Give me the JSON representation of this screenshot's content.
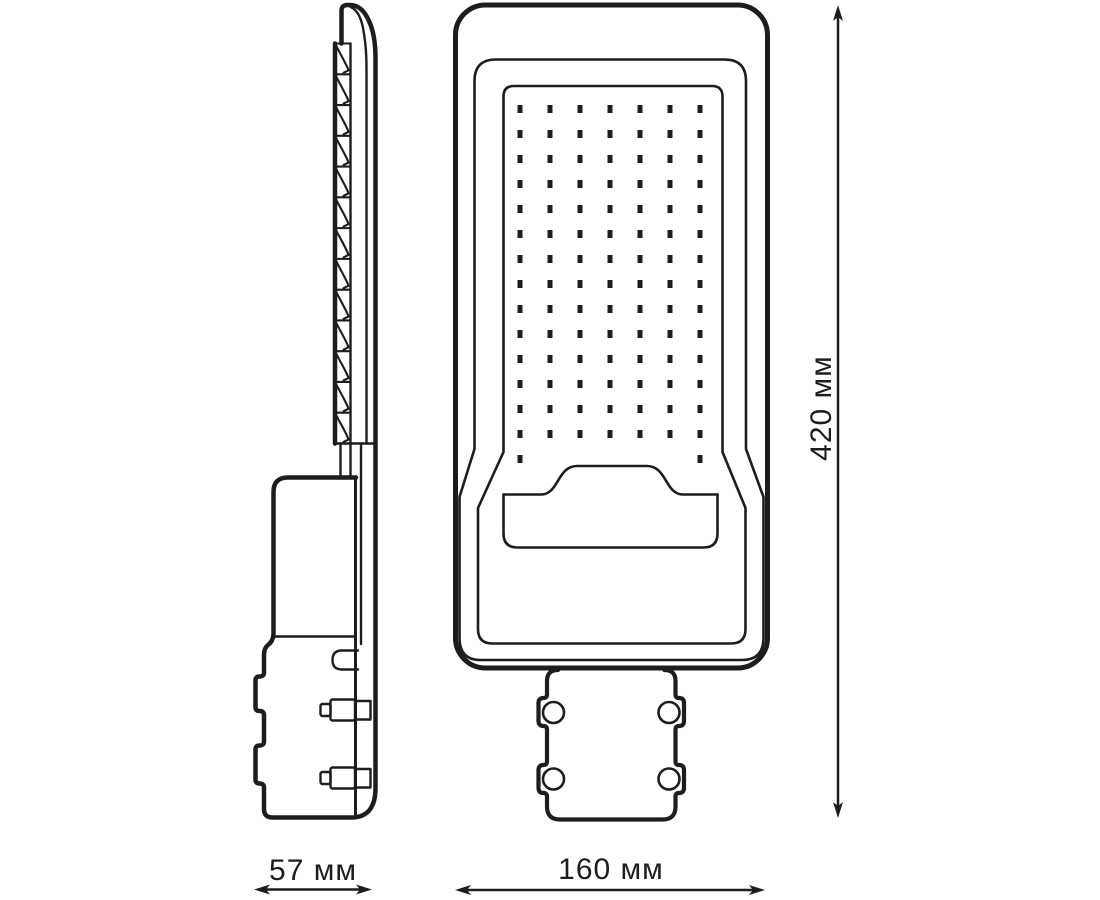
{
  "title": "LED street light dimensional drawing",
  "colors": {
    "line": "#1d1d1b",
    "background": "#ffffff"
  },
  "views": {
    "side": {
      "fins_count": 13
    },
    "front": {
      "led_count": 100
    }
  },
  "led_grid": {
    "cols": 7,
    "full_rows": 14,
    "col_start": 520,
    "col_gap": 30,
    "row_start": 109,
    "row_gap": 25,
    "dot_w": 5,
    "dot_h": 8,
    "partial_row": {
      "y": 459,
      "cols": [
        0,
        6
      ]
    }
  },
  "dimensions": [
    {
      "id": "height",
      "label": "420 мм",
      "orientation": "vertical"
    },
    {
      "id": "side-width",
      "label": "57 мм",
      "orientation": "horizontal"
    },
    {
      "id": "front-width",
      "label": "160 мм",
      "orientation": "horizontal"
    }
  ]
}
